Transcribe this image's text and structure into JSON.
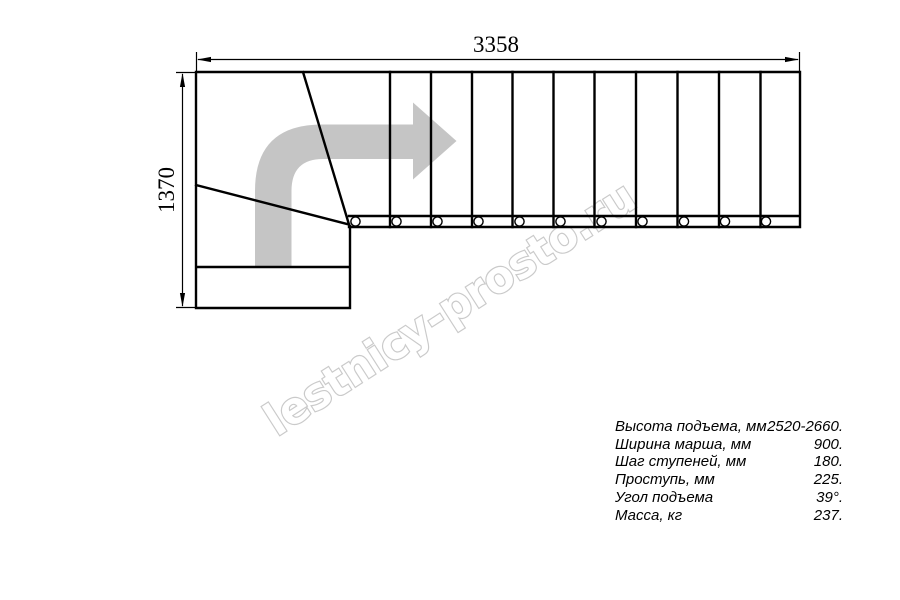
{
  "watermark": {
    "text": "lestnicy-prosto.ru"
  },
  "dimensions": {
    "width_label": "3358",
    "height_label": "1370"
  },
  "plan": {
    "direction_arrow_icon": "curved-arrow-up-then-right",
    "straight_flight_treads": 11,
    "tread_circle_marks": 11,
    "winder_divider_lines": 2
  },
  "specs": {
    "rows": [
      {
        "label": "Высота подъема, мм",
        "value": "2520-2660."
      },
      {
        "label": "Ширина марша, мм",
        "value": "900."
      },
      {
        "label": "Шаг ступеней, мм",
        "value": "180."
      },
      {
        "label": "Проступь, мм",
        "value": "225."
      },
      {
        "label": "Угол подъема",
        "value": "39°."
      },
      {
        "label": "Масса, кг",
        "value": "237."
      }
    ]
  },
  "colors": {
    "line": "#000000",
    "arrow": "#c5c5c5",
    "watermark_outline": "#cacaca",
    "background": "#ffffff"
  }
}
